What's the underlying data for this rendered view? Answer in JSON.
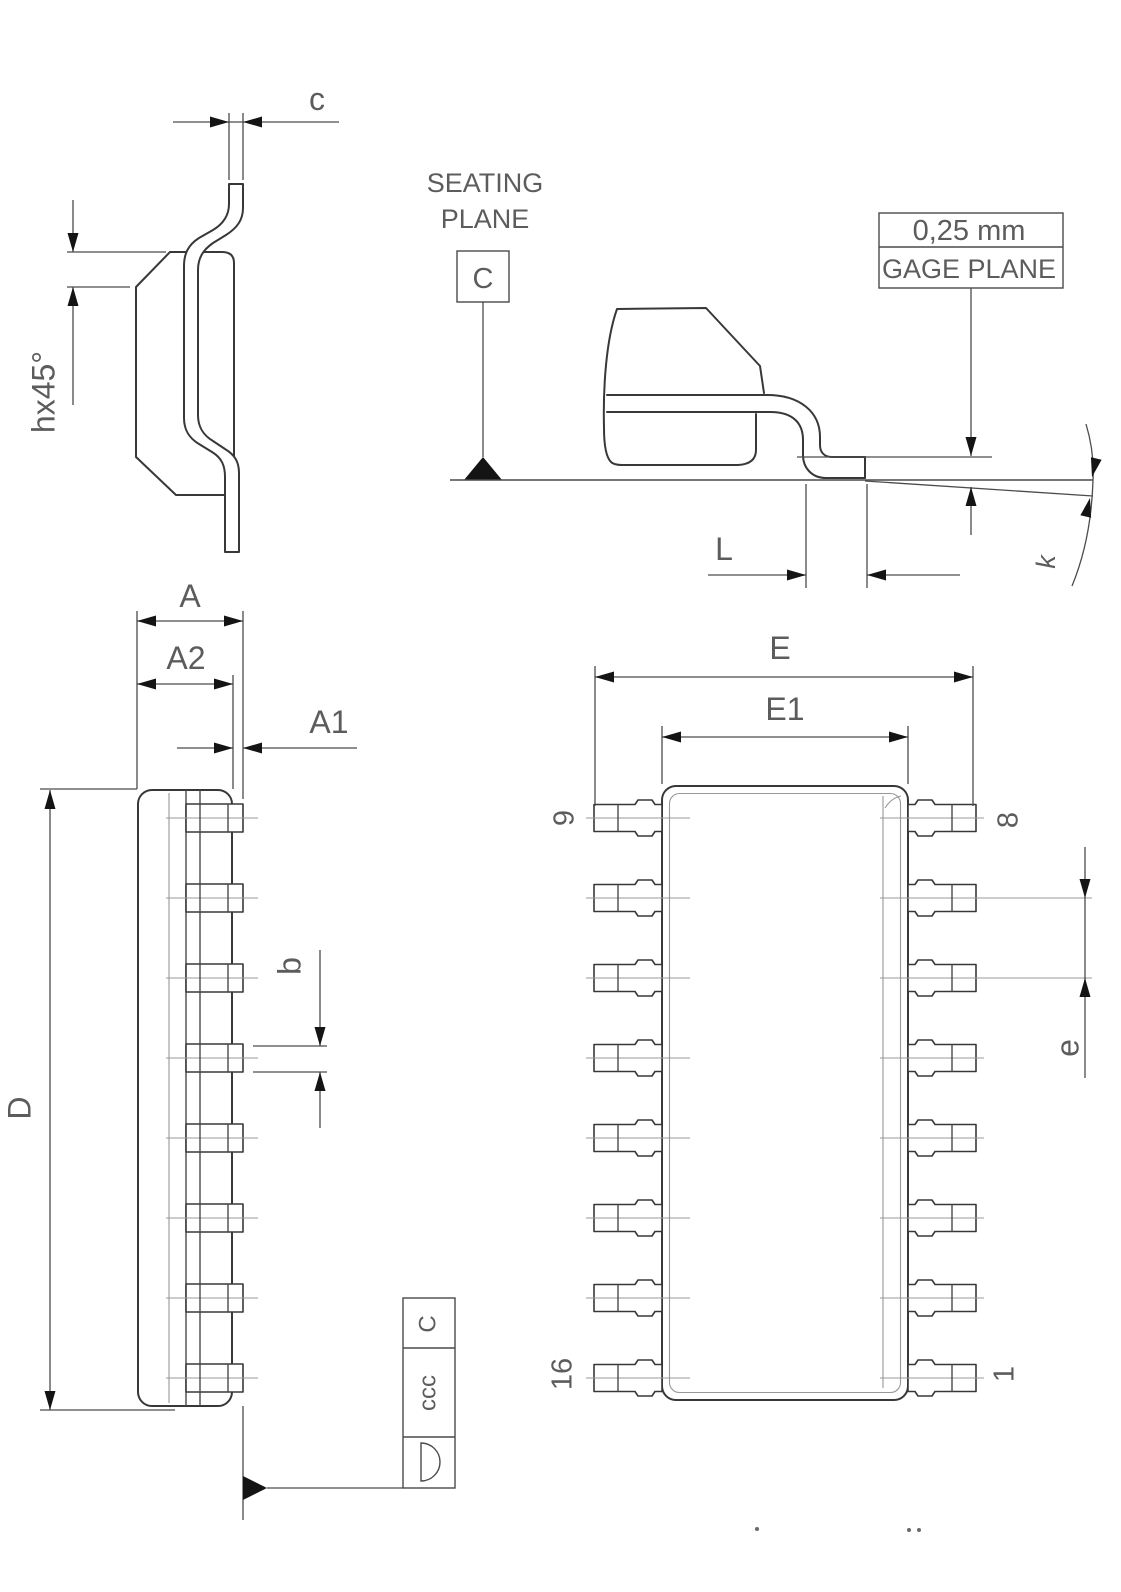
{
  "page": {
    "background": "#ffffff",
    "line_color": "#383838",
    "dimension_color": "#4c4c4c",
    "construction_color": "#989898",
    "text_color": "#5c5c5c",
    "arrow_color": "#141414"
  },
  "views": {
    "lead_section": {
      "dim_lead_thickness": "c",
      "dim_chamfer": "hx45°"
    },
    "seating_plane": {
      "title_line1": "SEATING",
      "title_line2": "PLANE",
      "datum": "C"
    },
    "lead_end": {
      "gage_value": "0,25  mm",
      "gage_label": "GAGE  PLANE",
      "dim_foot_length": "L",
      "dim_foot_angle": "k"
    },
    "side_view": {
      "dim_overall_width": "A",
      "dim_body_width": "A2",
      "dim_standoff": "A1",
      "dim_body_length": "D",
      "dim_lead_width": "b"
    },
    "tolerance_frame": {
      "symbol_name": "profile-of-surface-symbol",
      "value": "ccc",
      "datum": "C"
    },
    "top_view": {
      "dim_overall_span": "E",
      "dim_body_span": "E1",
      "dim_pitch": "e",
      "pins_per_side": 8,
      "pin_labels": {
        "top_left": "9",
        "top_right": "8",
        "bottom_left": "16",
        "bottom_right": "1"
      }
    }
  }
}
